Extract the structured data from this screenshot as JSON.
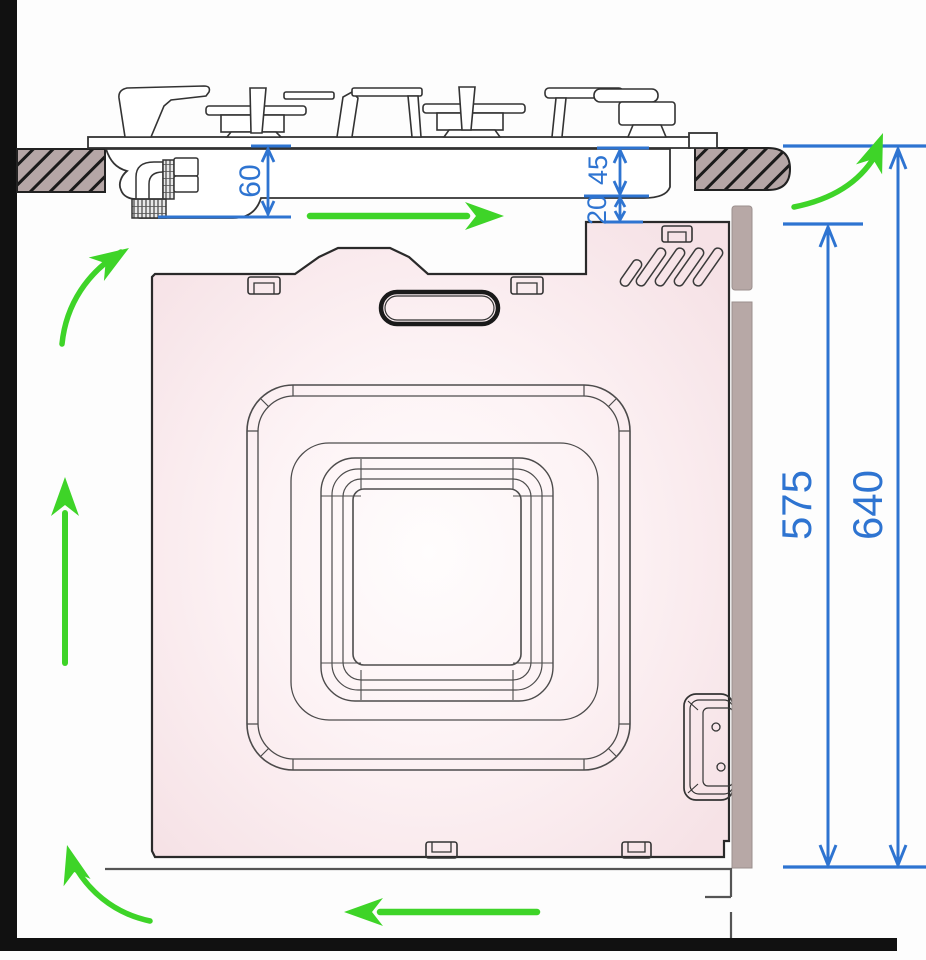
{
  "dims": {
    "d60": "60",
    "d45": "45",
    "d20": "20",
    "d575": "575",
    "d640": "640"
  },
  "colors": {
    "dimension_blue": "#2e74d1",
    "airflow_green": "#3ed428",
    "cabinet_grey": "#b7a8a6",
    "worktop_hatch_grey": "#b5a6a6",
    "oven_pink": "#f6e2e6",
    "structure_black": "#111111"
  },
  "airflow_arrows": [
    "airflow-arrow-up-left-curved",
    "airflow-arrow-right",
    "airflow-arrow-up-right-curved",
    "airflow-arrow-up",
    "airflow-arrow-bottom-left-curved",
    "airflow-arrow-left"
  ]
}
